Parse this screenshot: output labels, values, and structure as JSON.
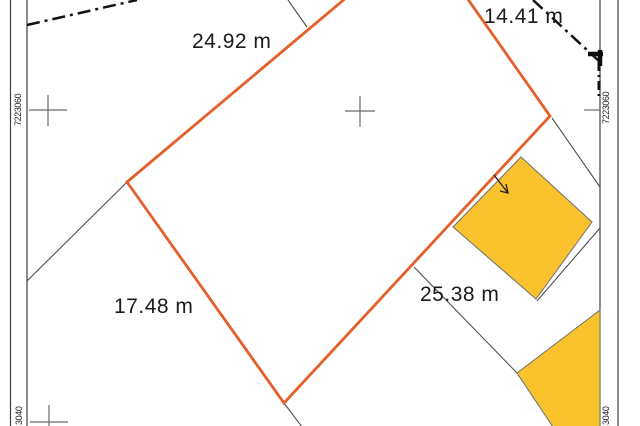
{
  "map": {
    "title": "cadastral parcel plan",
    "labels": {
      "edge_top": "24.92 m",
      "edge_right": "14.41 m",
      "edge_left": "17.48 m",
      "edge_bottom": "25.38 m"
    },
    "grid": {
      "northing_top_left": "7223060",
      "northing_top_right": "7223060",
      "northing_bottom_left": "3040",
      "northing_bottom_right": "3040",
      "crosses": [
        {
          "transform": "translate(48,110)"
        },
        {
          "transform": "translate(360,111)"
        },
        {
          "transform": "translate(49,422)"
        }
      ],
      "ticks": [
        {
          "x1": 584,
          "y1": 110,
          "x2": 600,
          "y2": 110
        },
        {
          "x1": 578,
          "y1": 414,
          "x2": 600,
          "y2": 414
        }
      ]
    },
    "frame": {
      "lines": [
        {
          "x1": 10.5,
          "y1": 0,
          "x2": 10.5,
          "y2": 426
        },
        {
          "x1": 27,
          "y1": 0,
          "x2": 27,
          "y2": 426
        },
        {
          "x1": 600,
          "y1": 0,
          "x2": 600,
          "y2": 426
        },
        {
          "x1": 618,
          "y1": 0,
          "x2": 618,
          "y2": 426
        }
      ]
    },
    "colors": {
      "parcel_stroke": "#e55f2b",
      "building_fill": "#fac32e",
      "neighbor_gray": "#4f4f4f",
      "boundary_black": "#121212"
    },
    "parcel": {
      "points": "127,182 422,-66 550,116 284,403"
    },
    "neighbor_lines": [
      {
        "x1": 288,
        "y1": 0,
        "x2": 307,
        "y2": 27
      },
      {
        "x1": 127,
        "y1": 182,
        "x2": 27,
        "y2": 281
      },
      {
        "x1": 552,
        "y1": 118,
        "x2": 600,
        "y2": 187
      },
      {
        "x1": 414,
        "y1": 267,
        "x2": 517,
        "y2": 373
      },
      {
        "x1": 517,
        "y1": 373,
        "x2": 554,
        "y2": 427
      },
      {
        "x1": 600,
        "y1": 228,
        "x2": 537,
        "y2": 301
      },
      {
        "x1": 284,
        "y1": 403,
        "x2": 302,
        "y2": 427
      }
    ],
    "boundary_dashdot": {
      "left": {
        "x1": 27,
        "y1": 25,
        "x2": 137,
        "y2": 0,
        "width": 2.5
      },
      "right_diag": {
        "x1": 533,
        "y1": 0,
        "x2": 600,
        "y2": 62,
        "width": 2.5
      },
      "right_vert": {
        "x1": 599,
        "y1": 62,
        "x2": 599,
        "y2": 98,
        "width": 3
      },
      "corner_h": {
        "x1": 588,
        "y1": 54,
        "x2": 603,
        "y2": 54,
        "width": 4.5
      },
      "corner_v": {
        "x1": 600,
        "y1": 50,
        "x2": 600,
        "y2": 66,
        "width": 4.5
      }
    },
    "buildings": [
      {
        "points": "521,157 592,222 536,299 453,227"
      },
      {
        "points": "517,373 600,310 600,427 553,427"
      }
    ],
    "arrow": {
      "x1": 494,
      "y1": 175,
      "x2": 508,
      "y2": 193,
      "head_points": "500,191 508,193 506,184"
    }
  }
}
